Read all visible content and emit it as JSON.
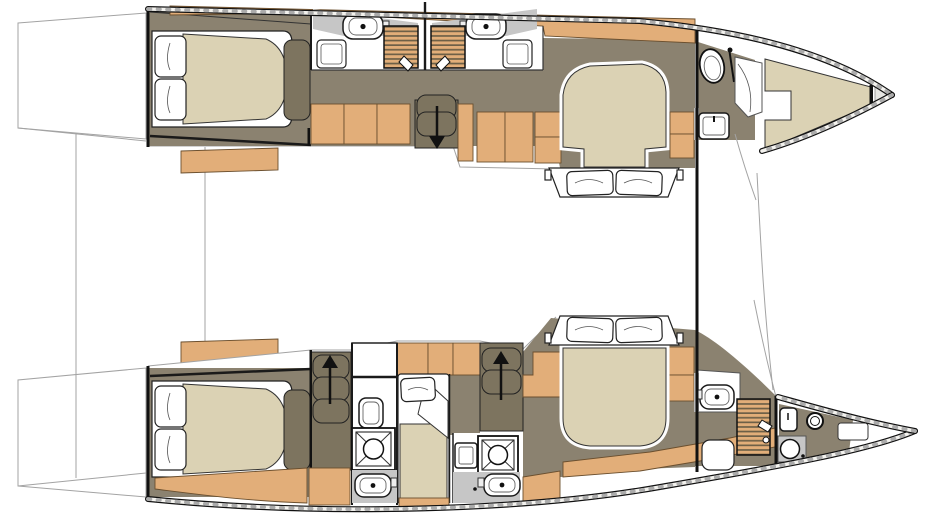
{
  "diagram": {
    "title": "catamaran-interior-deck-plan",
    "type": "boat-floor-plan-top-view",
    "hulls": {
      "port": {
        "label": "port-hull-top",
        "rooms": [
          {
            "label": "aft-double-cabin",
            "bed": "double",
            "pillows": 2
          },
          {
            "label": "twin-shower-rooms",
            "sinks": 2,
            "shower-grates": 2,
            "seats": 2
          },
          {
            "label": "companionway",
            "stairs": "down",
            "cabinets": 7
          },
          {
            "label": "forward-double-cabin",
            "bed": "island-double",
            "pillows": 2
          },
          {
            "label": "forward-heads",
            "toilet": 1,
            "sink": 1
          },
          {
            "label": "bow-berth",
            "cushion": 1
          },
          {
            "label": "anchor-locker",
            "position": "bow-tip"
          }
        ]
      },
      "starboard": {
        "label": "starboard-hull-bottom",
        "rooms": [
          {
            "label": "aft-double-cabin",
            "bed": "double",
            "pillows": 2
          },
          {
            "label": "companionway-aft",
            "stairs": "up"
          },
          {
            "label": "aft-shower-room",
            "toilet": 1,
            "shower-pan": 1,
            "sink": 1
          },
          {
            "label": "single-berth",
            "bed": "single",
            "pillows": 1
          },
          {
            "label": "companionway-mid",
            "stairs": "up"
          },
          {
            "label": "mid-shower-room",
            "shower-pan": 1,
            "sink": 1
          },
          {
            "label": "forward-double-cabin",
            "bed": "island-double",
            "pillows": 2
          },
          {
            "label": "forward-heads",
            "sink": 1,
            "shower-grate": 1,
            "seat": 1
          },
          {
            "label": "bow-compartment",
            "toilet": 1,
            "sink": 1,
            "hatch": 1,
            "shelf": 1
          }
        ]
      }
    },
    "bridgedeck": {
      "benches": 2,
      "crossbeam": 1,
      "trampoline-lines": 3
    },
    "totals": {
      "double-beds": 4,
      "single-berths": 1,
      "sinks": 7,
      "toilets": 3,
      "showers": 5,
      "staircases": 3
    }
  },
  "colors": {
    "paper": "#ffffff",
    "outline": "#1a1a1a",
    "wood": "#E2AE79",
    "woodEdge": "#6b4f2e",
    "cushion": "#DBD2B4",
    "floor": "#8B8270",
    "floorDark": "#7D745F",
    "counter": "#C6C6C6",
    "grate": "#6E6047",
    "thinline": "#A3A3A3",
    "bowtip": "#E6E6E3",
    "rail": "#ABABAB",
    "railLt": "#F4F3EF"
  }
}
